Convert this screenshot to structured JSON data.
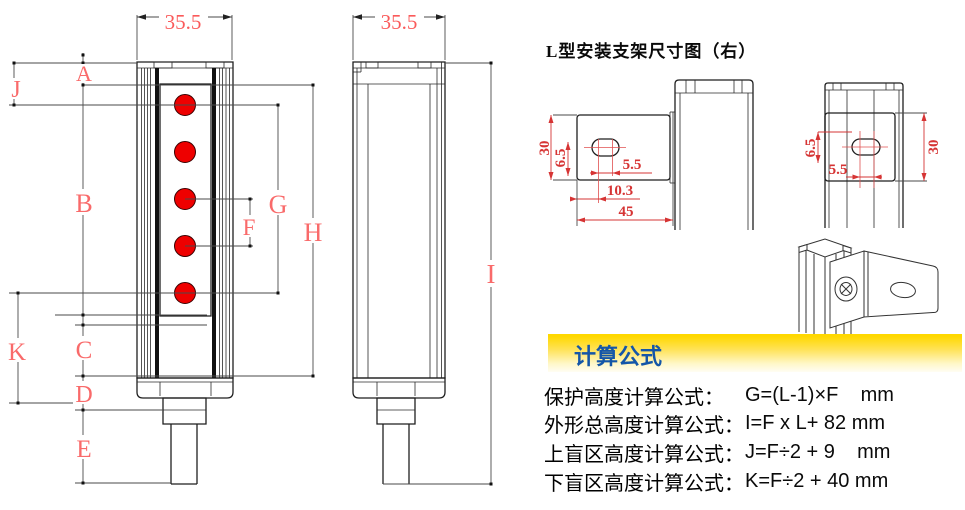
{
  "front_view": {
    "top_width": "35.5",
    "labels": {
      "A": "A",
      "B": "B",
      "C": "C",
      "D": "D",
      "E": "E",
      "F": "F",
      "G": "G",
      "H": "H",
      "J": "J",
      "K": "K"
    }
  },
  "side_view": {
    "top_width": "35.5",
    "total_height_label": "I"
  },
  "bracket": {
    "title": "L型安装支架尺寸图（右）",
    "side_view_dims": {
      "height": "30",
      "hole_offset": "6.5",
      "slot_span": "5.5",
      "edge_to_hole": "10.3",
      "width": "45"
    },
    "front_view_dims": {
      "hole_offset": "6.5",
      "slot_span": "5.5",
      "height": "30"
    }
  },
  "formulas": {
    "header": "计算公式",
    "rows": [
      {
        "label": "保护高度计算公式：",
        "formula": "G=(L-1)×F    mm"
      },
      {
        "label": "外形总高度计算公式：",
        "formula": "I=F x L+ 82 mm"
      },
      {
        "label": "上盲区高度计算公式：",
        "formula": "J=F÷2 + 9    mm"
      },
      {
        "label": "下盲区高度计算公式：",
        "formula": "K=F÷2 + 40 mm"
      }
    ]
  },
  "colors": {
    "dim_letter": "#f96a6a",
    "bracket_dim": "#d63434",
    "beam_dot": "#ee0000",
    "formula_header_blue": "#1456a8",
    "band_yellow": "#ffd800"
  }
}
